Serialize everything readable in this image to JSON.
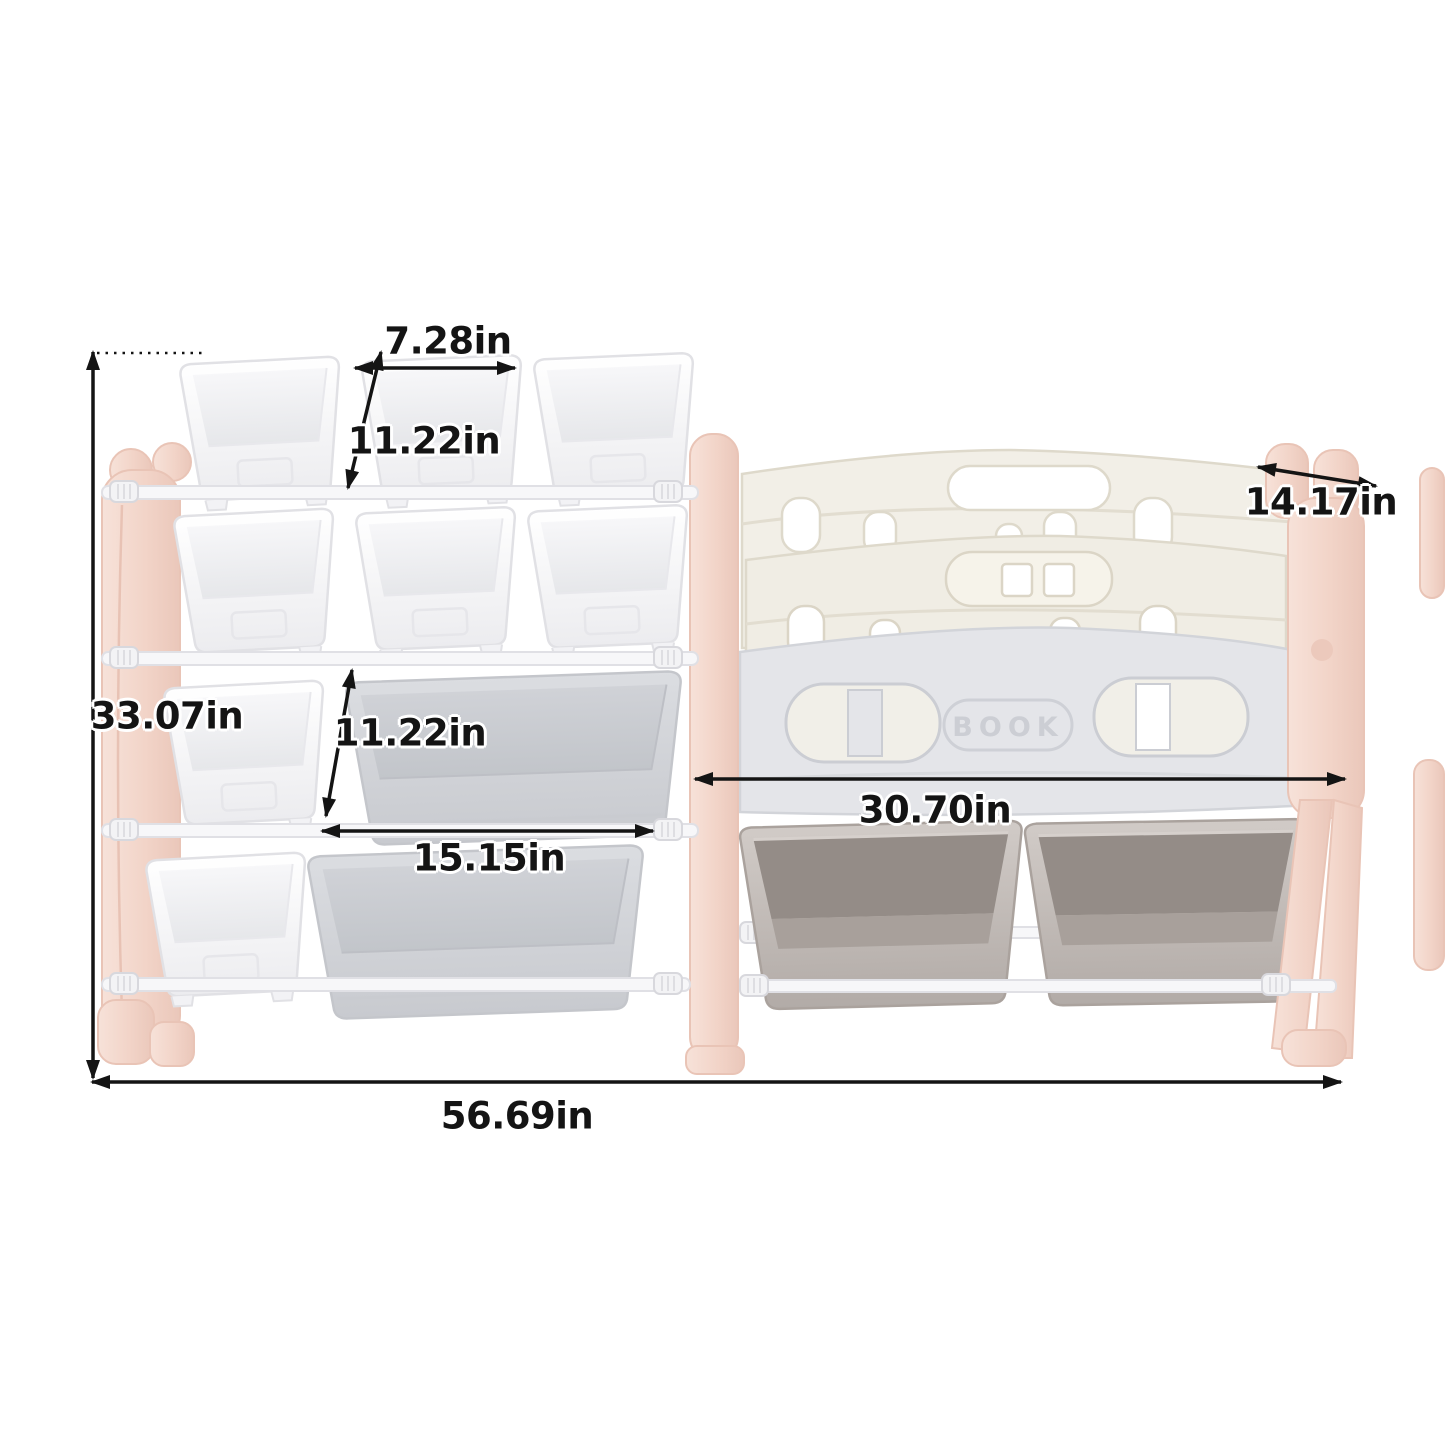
{
  "book_label": "BOOK",
  "dimensions": {
    "top_bin_width": "7.28in",
    "top_bin_depth": "11.22in",
    "shelf_depth": "14.17in",
    "overall_height": "33.07in",
    "middle_bin_depth": "11.22in",
    "large_bin_width": "15.15in",
    "bookshelf_width": "30.70in",
    "overall_width": "56.69in"
  },
  "colors": {
    "background": "#ffffff",
    "pink_support": "#f2d4c8",
    "cream_panel": "#f2efe7",
    "gray_panel": "#e4e5e9",
    "white_bin": "#fcfcfd",
    "gray_bin": "#d4d6da",
    "taupe_bin": "#c7c0bc",
    "dimension_line": "#141414",
    "book_text": "#ccced4"
  }
}
